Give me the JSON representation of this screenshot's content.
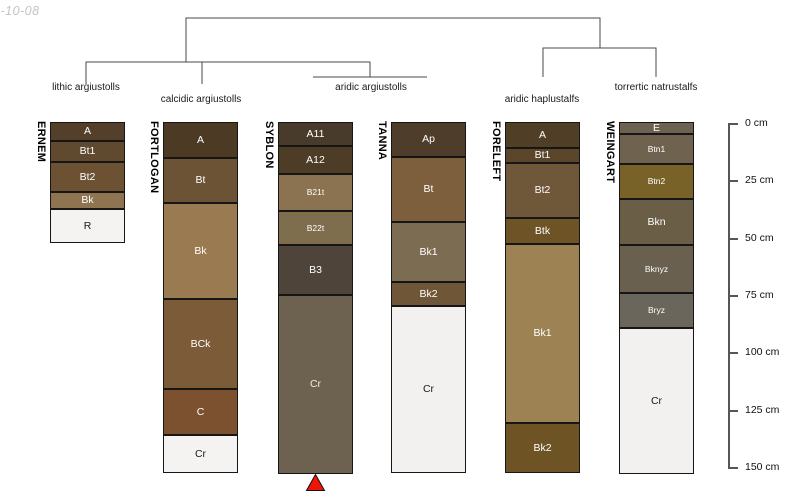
{
  "watermark": "5-10-08",
  "dendrogram": {
    "groups": [
      {
        "label": "lithic argiustolls",
        "profiles": [
          "ERNEM"
        ]
      },
      {
        "label": "calcidic argiustolls",
        "profiles": [
          "FORTLOGAN"
        ]
      },
      {
        "label": "aridic argiustolls",
        "profiles": [
          "SYBLON",
          "TANNA"
        ]
      },
      {
        "label": "aridic haplustalfs",
        "profiles": [
          "FORELEFT"
        ]
      },
      {
        "label": "torrertic natrustalfs",
        "profiles": [
          "WEINGART"
        ]
      }
    ]
  },
  "depth_scale": {
    "unit": "cm",
    "min": 0,
    "max": 150,
    "interval": 25,
    "tick_labels": [
      "0 cm",
      "25 cm",
      "50 cm",
      "75 cm",
      "100 cm",
      "125 cm",
      "150 cm"
    ]
  },
  "profiles": [
    {
      "name": "ERNEM",
      "group": "lithic argiustolls",
      "horizons": [
        {
          "label": "A",
          "top_cm": 0,
          "bottom_cm": 8.1,
          "color": "#54402a",
          "text_color": "#ffffff"
        },
        {
          "label": "Bt1",
          "top_cm": 8.1,
          "bottom_cm": 17.1,
          "color": "#5f492f",
          "text_color": "#ffffff"
        },
        {
          "label": "Bt2",
          "top_cm": 17.1,
          "bottom_cm": 29.9,
          "color": "#6c5233",
          "text_color": "#ffffff"
        },
        {
          "label": "Bk",
          "top_cm": 29.9,
          "bottom_cm": 37.2,
          "color": "#8e7450",
          "text_color": "#ffffff"
        },
        {
          "label": "R",
          "top_cm": 37.2,
          "bottom_cm": 51.7,
          "color": "#f4f3f1",
          "text_color": "#1a1a1a"
        }
      ]
    },
    {
      "name": "FORTLOGAN",
      "group": "calcidic argiustolls",
      "horizons": [
        {
          "label": "A",
          "top_cm": 0,
          "bottom_cm": 15.4,
          "color": "#4d3a25",
          "text_color": "#ffffff"
        },
        {
          "label": "Bt",
          "top_cm": 15.4,
          "bottom_cm": 34.6,
          "color": "#6c5335",
          "text_color": "#ffffff"
        },
        {
          "label": "Bk",
          "top_cm": 34.6,
          "bottom_cm": 75.6,
          "color": "#9a7a50",
          "text_color": "#ffffff"
        },
        {
          "label": "BCk",
          "top_cm": 75.6,
          "bottom_cm": 114.1,
          "color": "#7c5b39",
          "text_color": "#ffffff"
        },
        {
          "label": "C",
          "top_cm": 114.1,
          "bottom_cm": 133.8,
          "color": "#7b5130",
          "text_color": "#ffffff"
        },
        {
          "label": "Cr",
          "top_cm": 133.8,
          "bottom_cm": 150,
          "color": "#f4f3f1",
          "text_color": "#1a1a1a"
        }
      ]
    },
    {
      "name": "SYBLON",
      "group": "aridic argiustolls",
      "horizons": [
        {
          "label": "A11",
          "top_cm": 0,
          "bottom_cm": 10.3,
          "color": "#493b2b",
          "text_color": "#ffffff"
        },
        {
          "label": "A12",
          "top_cm": 10.3,
          "bottom_cm": 22.2,
          "color": "#4d3c26",
          "text_color": "#ffffff"
        },
        {
          "label": "B21t",
          "top_cm": 22.2,
          "bottom_cm": 38,
          "color": "#8b7250",
          "text_color": "#ffffff"
        },
        {
          "label": "B22t",
          "top_cm": 38,
          "bottom_cm": 52.6,
          "color": "#7f6e4e",
          "text_color": "#ffffff"
        },
        {
          "label": "B3",
          "top_cm": 52.6,
          "bottom_cm": 73.9,
          "color": "#4e443a",
          "text_color": "#ffffff"
        },
        {
          "label": "Cr",
          "top_cm": 73.9,
          "bottom_cm": 150.4,
          "color": "#6d624f",
          "text_color": "#efece4"
        }
      ]
    },
    {
      "name": "TANNA",
      "group": "aridic argiustolls",
      "horizons": [
        {
          "label": "Ap",
          "top_cm": 0,
          "bottom_cm": 15,
          "color": "#4f3d2b",
          "text_color": "#ffffff"
        },
        {
          "label": "Bt",
          "top_cm": 15,
          "bottom_cm": 42.7,
          "color": "#7d5f3d",
          "text_color": "#ffffff"
        },
        {
          "label": "Bk1",
          "top_cm": 42.7,
          "bottom_cm": 68.4,
          "color": "#7c6d52",
          "text_color": "#ffffff"
        },
        {
          "label": "Bk2",
          "top_cm": 68.4,
          "bottom_cm": 78.6,
          "color": "#6e5636",
          "text_color": "#ffffff"
        },
        {
          "label": "Cr",
          "top_cm": 78.6,
          "bottom_cm": 150,
          "color": "#f2f1ef",
          "text_color": "#1a1a1a"
        }
      ]
    },
    {
      "name": "FORELEFT",
      "group": "aridic haplustalfs",
      "horizons": [
        {
          "label": "A",
          "top_cm": 0,
          "bottom_cm": 11.1,
          "color": "#513e27",
          "text_color": "#ffffff"
        },
        {
          "label": "Bt1",
          "top_cm": 11.1,
          "bottom_cm": 17.5,
          "color": "#5b452b",
          "text_color": "#ffffff"
        },
        {
          "label": "Bt2",
          "top_cm": 17.5,
          "bottom_cm": 41,
          "color": "#6f573a",
          "text_color": "#ffffff"
        },
        {
          "label": "Btk",
          "top_cm": 41,
          "bottom_cm": 52.1,
          "color": "#6d5326",
          "text_color": "#ffffff"
        },
        {
          "label": "Bk1",
          "top_cm": 52.1,
          "bottom_cm": 128.6,
          "color": "#9d8253",
          "text_color": "#ffffff"
        },
        {
          "label": "Bk2",
          "top_cm": 128.6,
          "bottom_cm": 150,
          "color": "#6e5425",
          "text_color": "#ffffff"
        }
      ]
    },
    {
      "name": "WEINGART",
      "group": "torrertic natrustalfs",
      "horizons": [
        {
          "label": "E",
          "top_cm": 0,
          "bottom_cm": 5.1,
          "color": "#6d6251",
          "text_color": "#ffffff"
        },
        {
          "label": "Btn1",
          "top_cm": 5.1,
          "bottom_cm": 17.9,
          "color": "#6f6350",
          "text_color": "#ffffff"
        },
        {
          "label": "Btn2",
          "top_cm": 17.9,
          "bottom_cm": 32.9,
          "color": "#786228",
          "text_color": "#ffffff"
        },
        {
          "label": "Bkn",
          "top_cm": 32.9,
          "bottom_cm": 52.6,
          "color": "#6b5e46",
          "text_color": "#ffffff"
        },
        {
          "label": "Bknyz",
          "top_cm": 52.6,
          "bottom_cm": 73.1,
          "color": "#696050",
          "text_color": "#ffffff"
        },
        {
          "label": "Bryz",
          "top_cm": 73.1,
          "bottom_cm": 88,
          "color": "#6b665b",
          "text_color": "#ffffff"
        },
        {
          "label": "Cr",
          "top_cm": 88,
          "bottom_cm": 150.4,
          "color": "#f2f1ef",
          "text_color": "#1a1a1a"
        }
      ]
    }
  ],
  "marker": {
    "shape": "triangle-up",
    "color": "#ee1507",
    "under_profile": "SYBLON"
  }
}
